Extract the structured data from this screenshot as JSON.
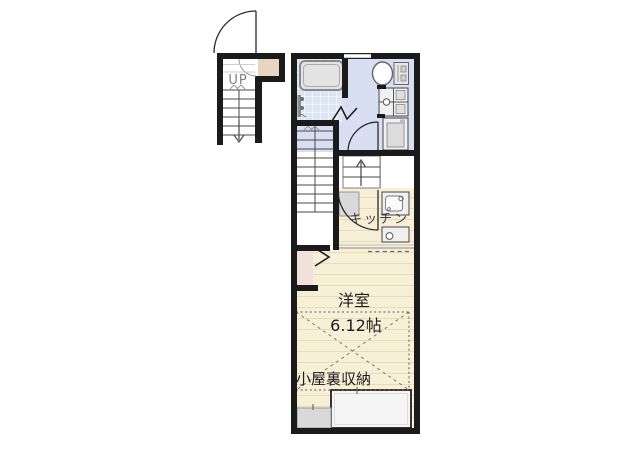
{
  "floorplan": {
    "entrance": {
      "up_label": "UP"
    },
    "kitchen_label": "キッチン",
    "room": {
      "label": "洋室",
      "size": "6.12帖"
    },
    "attic_label": "小屋裏収納",
    "colors": {
      "wall": "#1b1b1b",
      "washroom_floor": "#d8dff2",
      "bathroom_tile": "#dde6f5",
      "wood_floor": "#f8efd7",
      "wood_floor_line": "#e6dcbc",
      "genkan_floor": "#e8d5bf",
      "closet_floor": "#f2e1da",
      "fixture_gray": "#d9d9d9"
    }
  }
}
